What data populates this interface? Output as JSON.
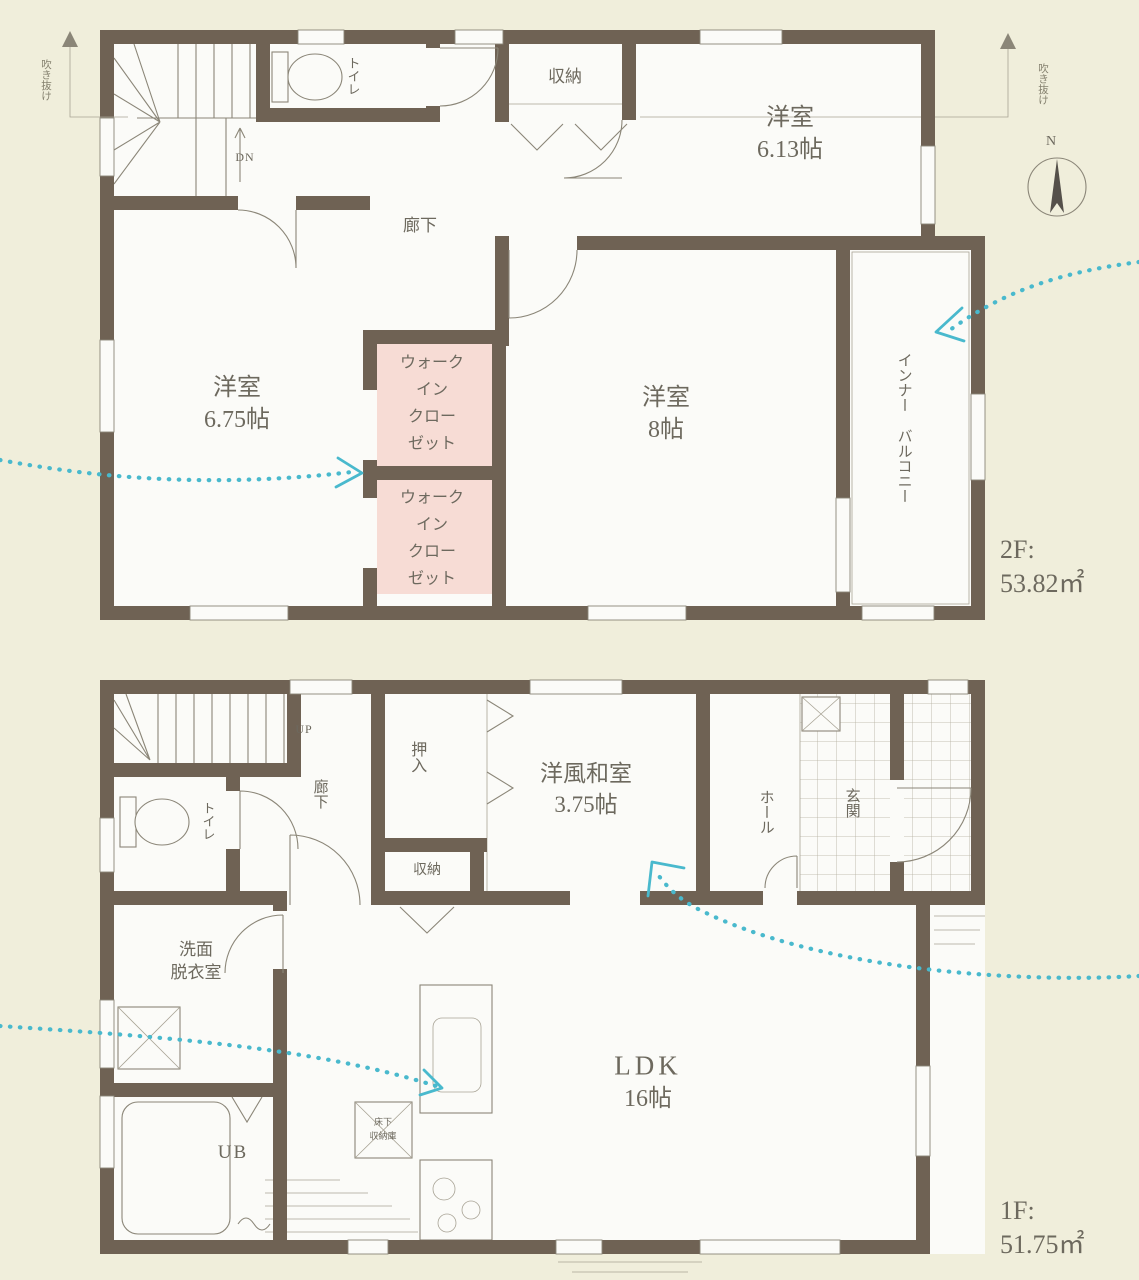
{
  "colors": {
    "background": "#f0eedb",
    "wall": "#6f6254",
    "room": "#fbfbf8",
    "closet_pink": "#f7dcd5",
    "airflow_teal": "#49b9cd",
    "linework": "#8b8678",
    "text": "#6d695e"
  },
  "compass": {
    "north_label": "N"
  },
  "roof_notes": {
    "left": "吹き抜け",
    "right": "吹き抜け"
  },
  "floor2": {
    "area_label": "2F:",
    "area_value": "53.82㎡",
    "rooms": {
      "bedroom_613": {
        "name": "洋室",
        "size": "6.13帖"
      },
      "bedroom_675": {
        "name": "洋室",
        "size": "6.75帖"
      },
      "bedroom_8": {
        "name": "洋室",
        "size": "8帖"
      },
      "storage": "収納",
      "toilet": "トイレ",
      "hallway": "廊下",
      "stairs_note": "DN",
      "walkin_closet": {
        "l1": "ウォーク",
        "l2": "イン",
        "l3": "クロー",
        "l4": "ゼット"
      },
      "balcony": {
        "l1": "インナー",
        "l2": "バルコニー"
      }
    }
  },
  "floor1": {
    "area_label": "1F:",
    "area_value": "51.75㎡",
    "rooms": {
      "washitsu": {
        "name": "洋風和室",
        "size": "3.75帖"
      },
      "ldk": {
        "name": "LDK",
        "size": "16帖"
      },
      "oshiire": "押入",
      "storage": "収納",
      "toilet": "トイレ",
      "hallway": "廊下",
      "stairs_note": "UP",
      "hall": "ホール",
      "genkan": "玄関",
      "senmen": {
        "l1": "洗面",
        "l2": "脱衣室"
      },
      "unit_bath": "UB",
      "underfloor": {
        "l1": "床下",
        "l2": "収納庫"
      }
    }
  }
}
